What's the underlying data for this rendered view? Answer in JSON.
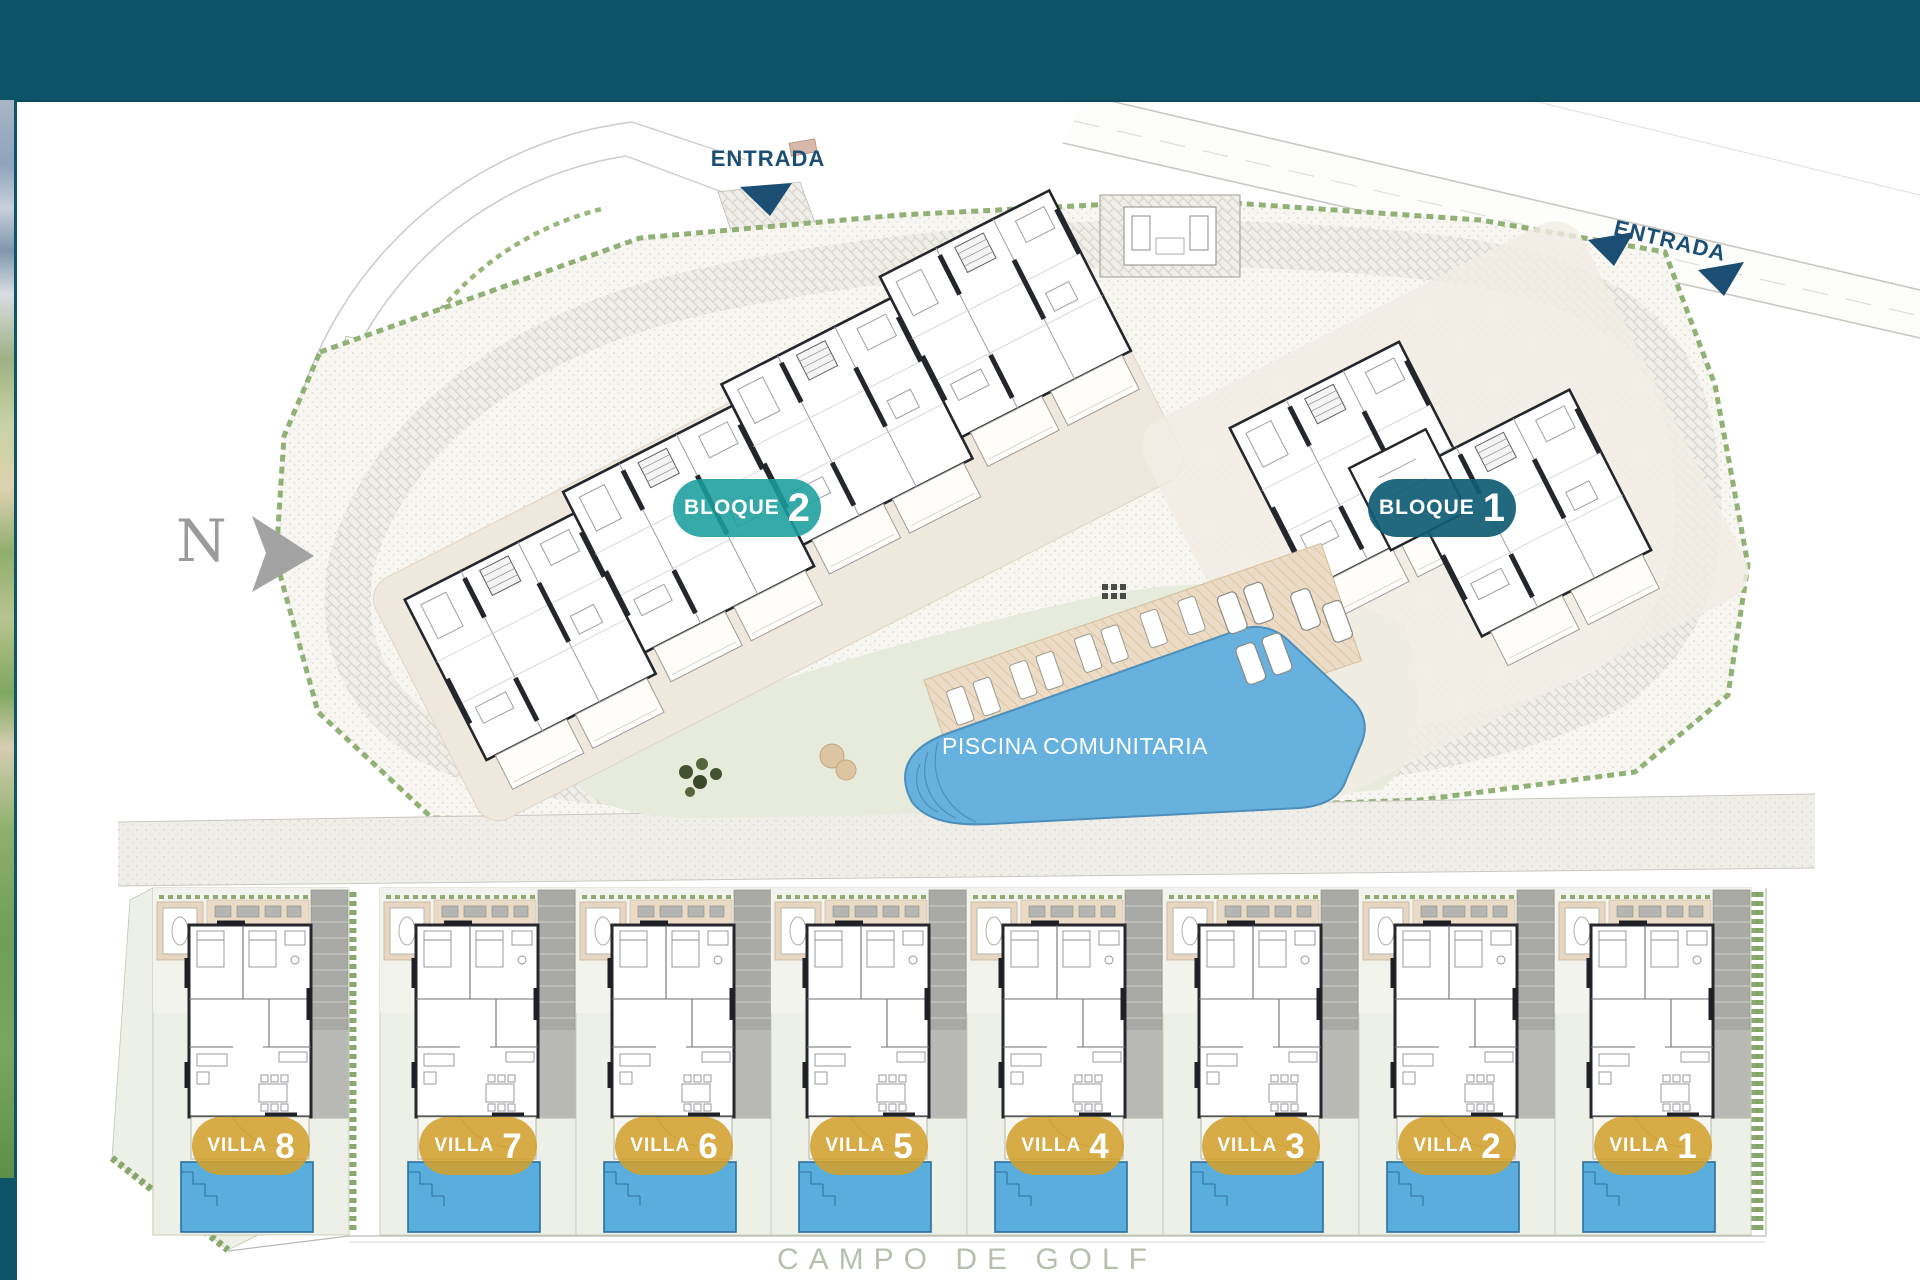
{
  "header": {
    "background_color": "#0e5468"
  },
  "photo_strip": {
    "name": "golf-aerial-photo-strip"
  },
  "plan": {
    "north_label": "N",
    "entrance_top": {
      "label": "ENTRADA"
    },
    "entrance_right": {
      "label": "ENTRADA"
    },
    "entrance_color": "#1c4d73",
    "blocks": [
      {
        "label": "BLOQUE",
        "number": "2",
        "badge_color": "#1a9e9d"
      },
      {
        "label": "BLOQUE",
        "number": "1",
        "badge_color": "#115c75"
      }
    ],
    "pool": {
      "label": "PISCINA COMUNITARIA",
      "water_color": "#66b1de"
    },
    "villas": [
      {
        "label": "VILLA",
        "number": "8"
      },
      {
        "label": "VILLA",
        "number": "7"
      },
      {
        "label": "VILLA",
        "number": "6"
      },
      {
        "label": "VILLA",
        "number": "5"
      },
      {
        "label": "VILLA",
        "number": "4"
      },
      {
        "label": "VILLA",
        "number": "3"
      },
      {
        "label": "VILLA",
        "number": "2"
      },
      {
        "label": "VILLA",
        "number": "1"
      }
    ],
    "villa_badge_color": "#d3a02c",
    "golf_label": "CAMPO DE GOLF"
  }
}
